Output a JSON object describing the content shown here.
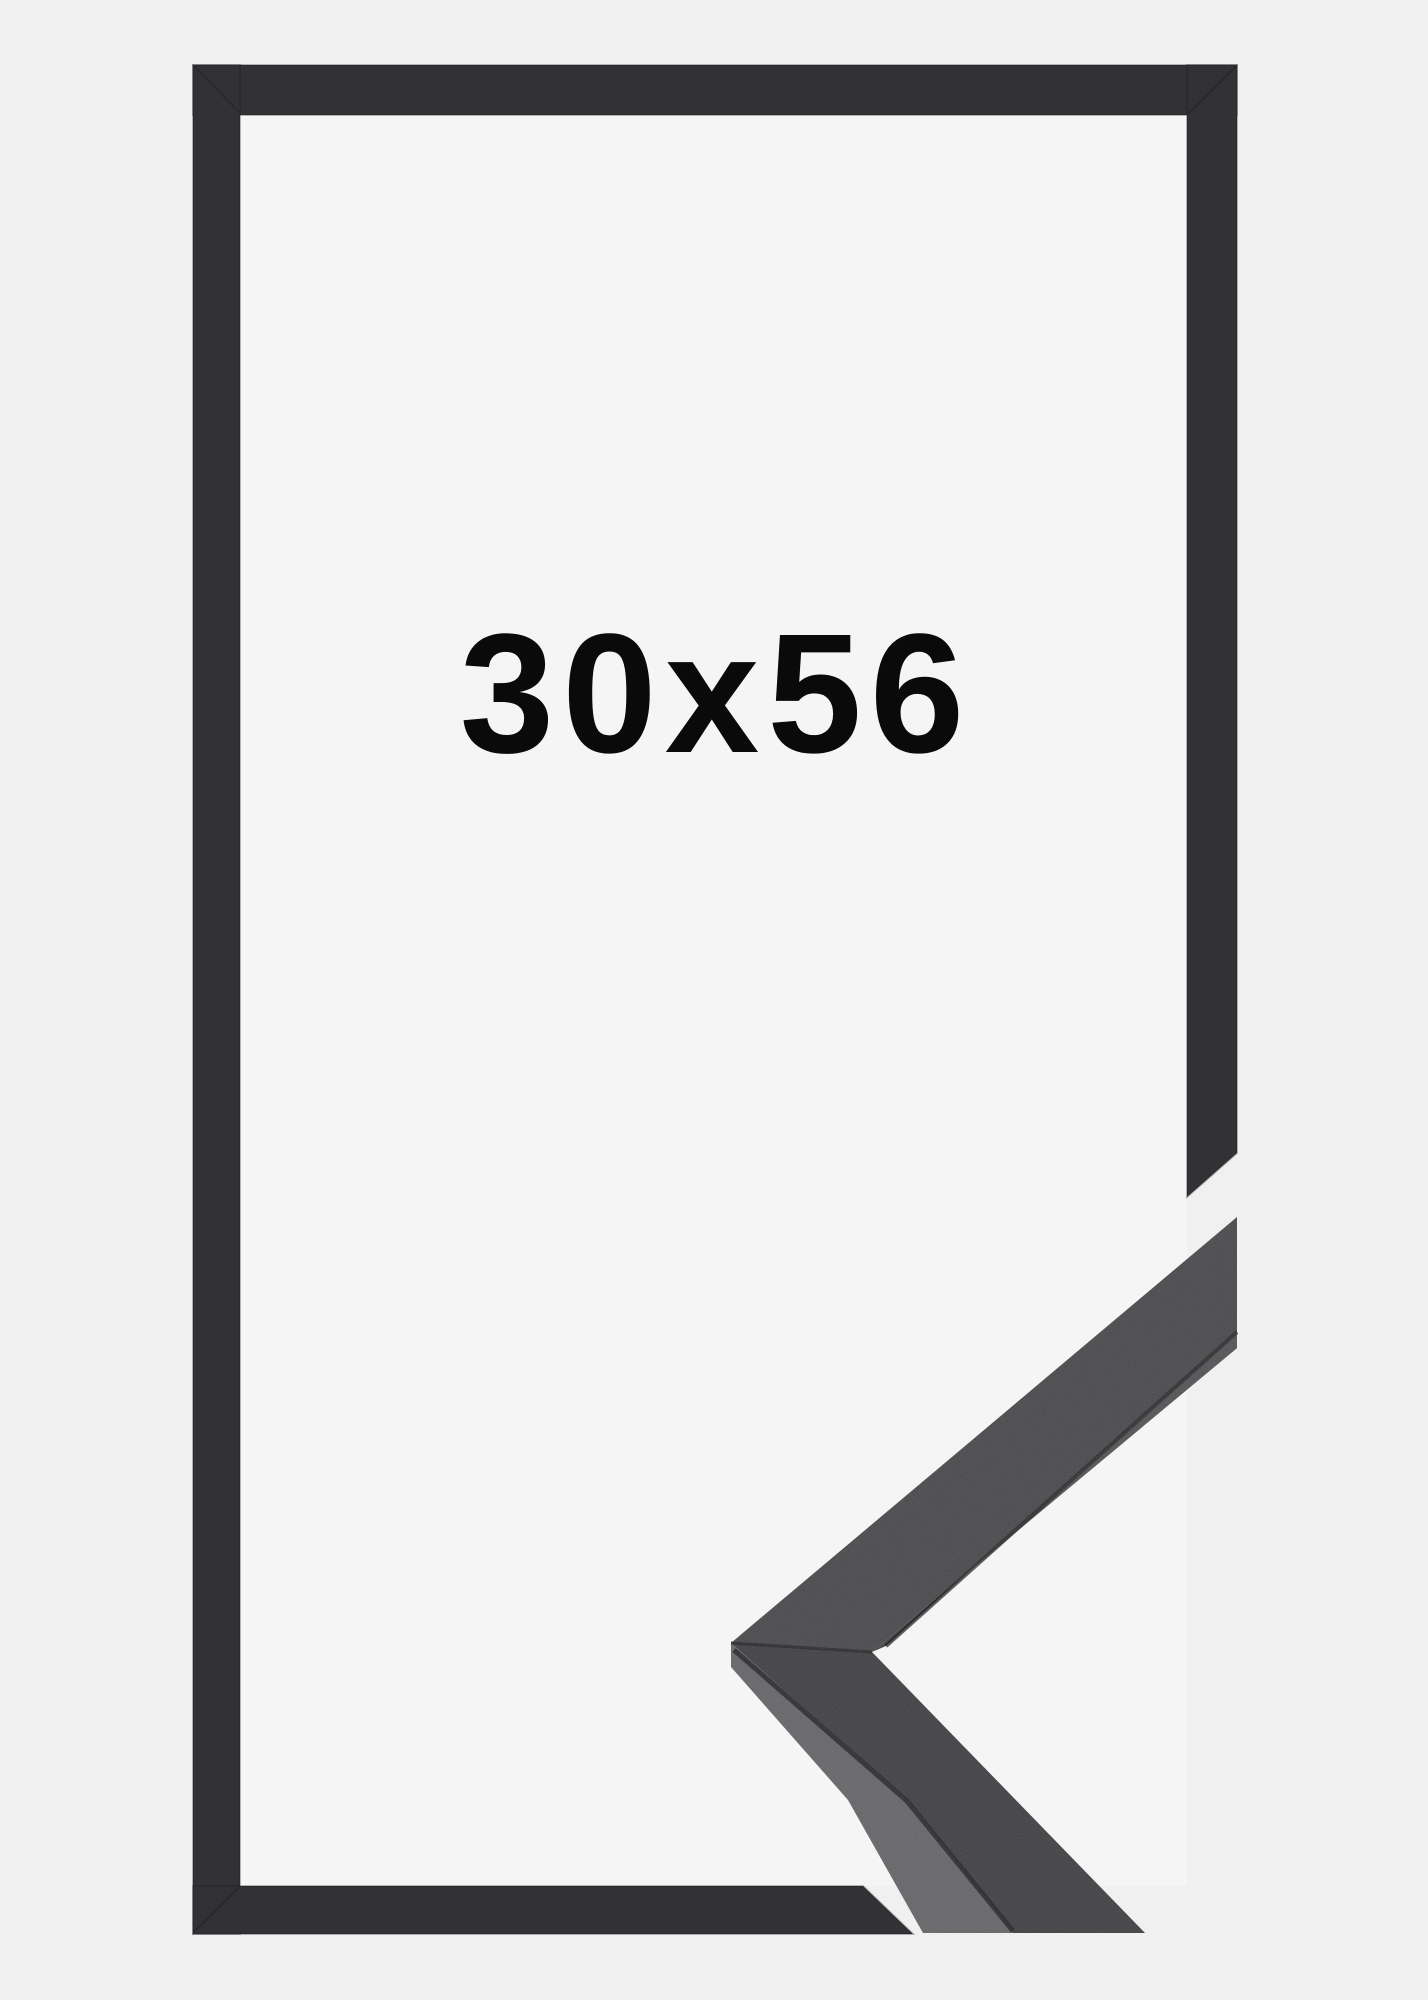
{
  "product": {
    "size_label": "30x56"
  },
  "colors": {
    "background": "#f0f0f1",
    "frame_opening": "#f5f5f6",
    "frame_front": "#323235",
    "moulding_top_face": "#434345",
    "moulding_front_face": "#3a3a3d",
    "moulding_side_face": "#616164",
    "moulding_edge_strip": "#4d4d50",
    "seam": "#1e1e20",
    "label_text": "#0a0a0a"
  }
}
